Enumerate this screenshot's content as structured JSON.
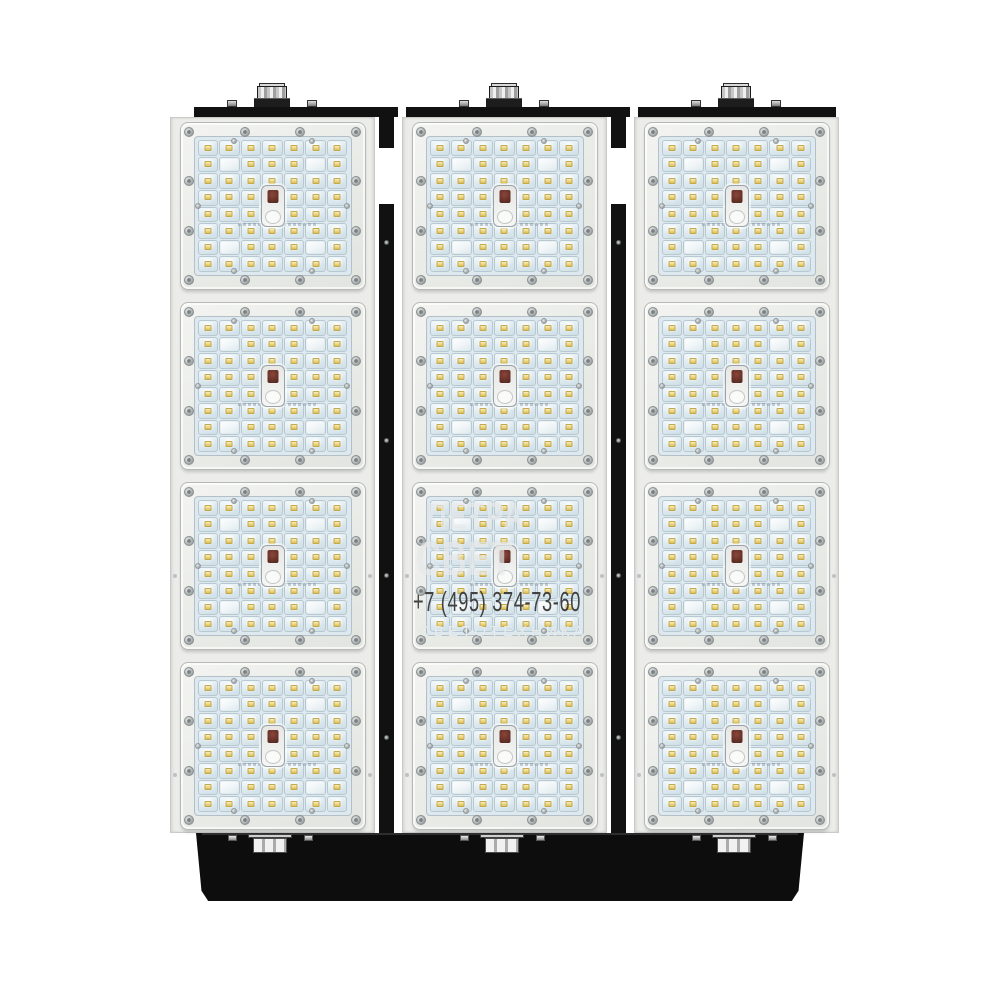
{
  "watermark": {
    "brand_line1": "ПЕТРА",
    "brand_line2": "СВЕТ",
    "phone": "+7 (495) 374-73-60",
    "subtitle": "СВЕТОТЕХНИКА"
  },
  "fixture": {
    "columns": 3,
    "modules_per_column": 4,
    "led_grid": {
      "cols": 7,
      "rows": 8,
      "blank_cells": [
        [
          2,
          2
        ],
        [
          2,
          6
        ],
        [
          7,
          2
        ],
        [
          7,
          6
        ]
      ],
      "center_element": {
        "col": 4,
        "rows": [
          4,
          5
        ]
      }
    },
    "cable_glands_top": 3,
    "cable_glands_bottom": 3,
    "colors": {
      "background": "#ffffff",
      "housing_black": "#111111",
      "panel_white": "#ececea",
      "module_frame": "#e9ebe7",
      "led_plate": "#dde9ee",
      "led_chip": "#ecd57e",
      "screw": "#a9aeae",
      "phone_text": "#414141",
      "watermark_text": "rgba(255,255,255,0.55)"
    }
  }
}
